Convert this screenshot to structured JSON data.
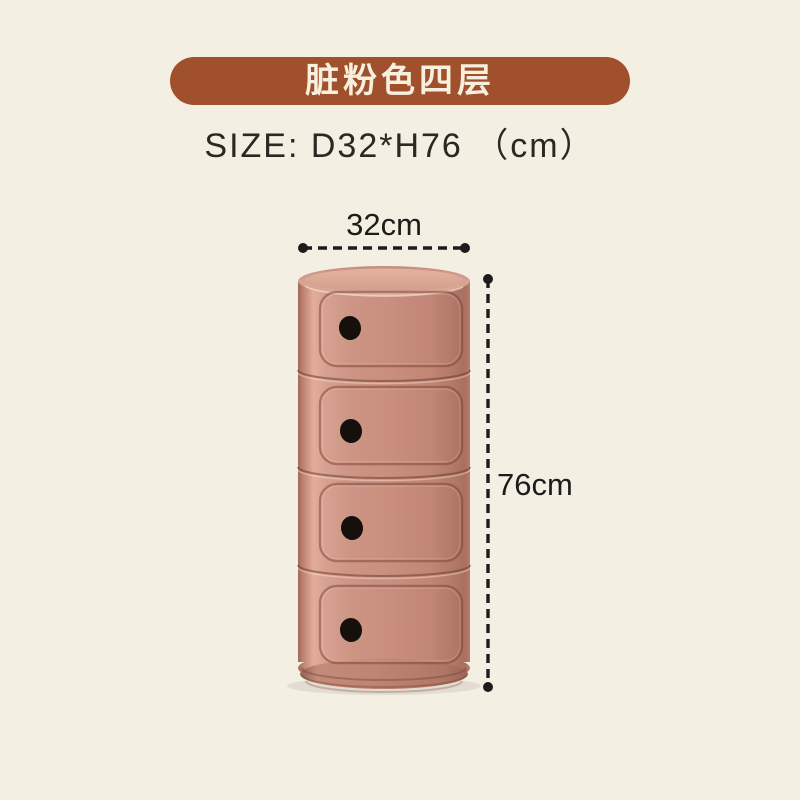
{
  "page": {
    "background_color": "#F3EFE2"
  },
  "banner": {
    "label": "脏粉色四层",
    "background_color": "#A0502C",
    "text_color": "#F7F0DE"
  },
  "size_spec": {
    "label": "SIZE: D32*H76 （cm）",
    "text_color": "#2B2722"
  },
  "dimension_annotations": {
    "width": {
      "label": "32cm"
    },
    "height": {
      "label": "76cm"
    },
    "line_color": "#1C1C1C"
  },
  "product": {
    "tiers": 4,
    "body_color": "#C9907F",
    "highlight_color": "#E0AC99",
    "finger_hole_color": "#16100C"
  }
}
